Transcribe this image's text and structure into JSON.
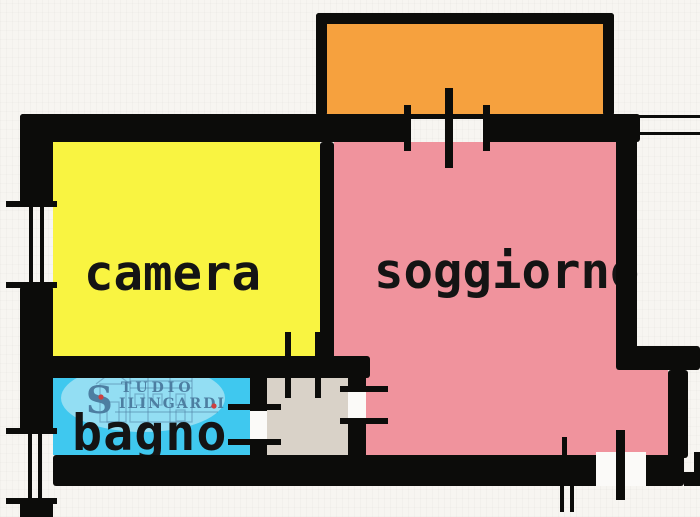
{
  "plan_title": "apartment floor plan",
  "rooms": {
    "camera": {
      "label": "camera",
      "color": "#f9f441"
    },
    "soggiorno": {
      "label": "soggiorno",
      "color": "#f0939d"
    },
    "bagno": {
      "label": "bagno",
      "color": "#3fc8ef"
    },
    "balcone": {
      "color": "#f6a13e"
    },
    "ingresso": {
      "color": "#d9d2c8"
    }
  },
  "watermark": {
    "initial": "S",
    "line1": "TUDIO",
    "line2": "ILINGARDI"
  },
  "colors": {
    "wall": "#0c0c0a",
    "background": "#f7f5f1",
    "label_text": "#141414",
    "watermark_oval": "#9fe0f4",
    "watermark_text": "#4d7ea1",
    "watermark_dot": "#cd4040",
    "door_gap": "#fbfaf8"
  }
}
